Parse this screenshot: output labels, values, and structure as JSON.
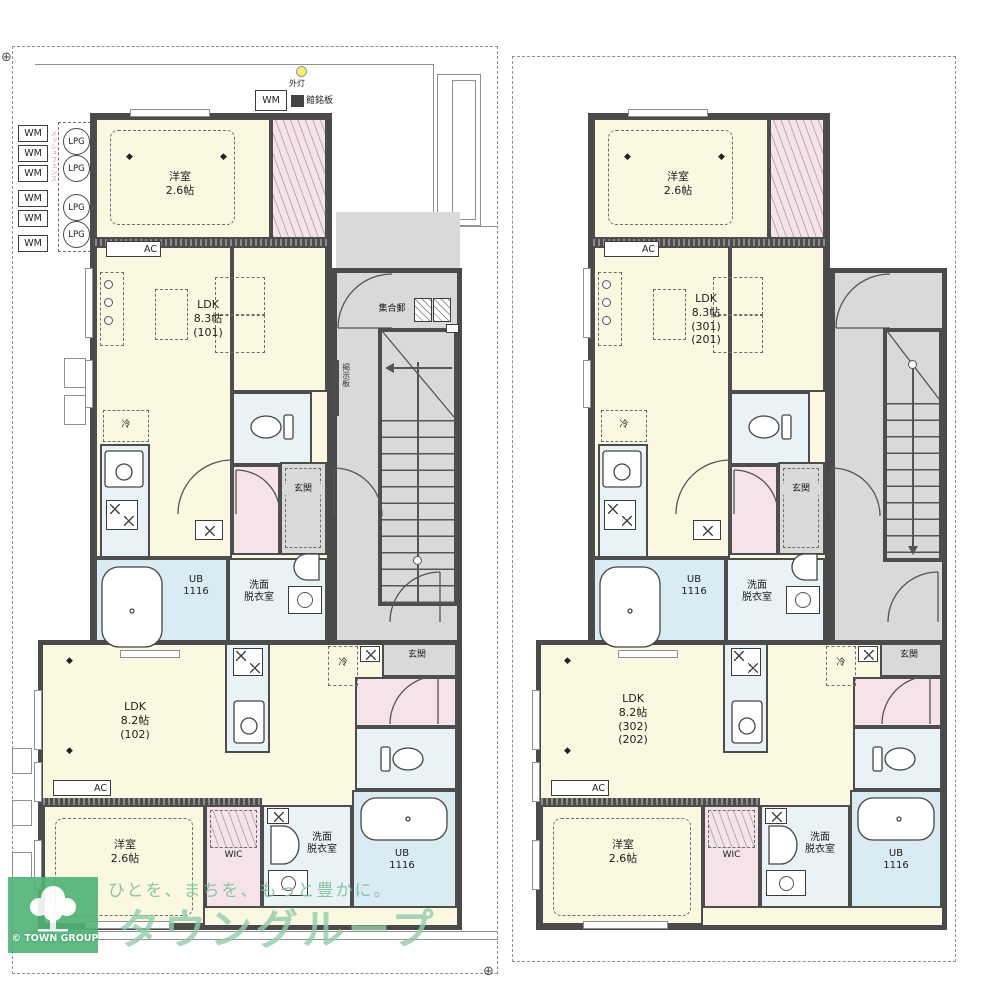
{
  "branding": {
    "tagline": "ひとを、まちを、もっと豊かに。",
    "company": "タウングループ",
    "logo_caption": "TOWN GROUP",
    "copyright": "©",
    "green_box": "#4eb377",
    "green_text": "#92ccac"
  },
  "site": {
    "wm": "WM",
    "lpg": "LPG",
    "outdoor_light": "外灯",
    "nameplate": "館銘板",
    "mailbox": "集合郵",
    "bulletin": "掲示板",
    "fence_note": "メッシュフェンス"
  },
  "common": {
    "ac": "AC",
    "fridge": "冷",
    "entrance": "玄関",
    "wic": "WIC",
    "washroom": "洗面\n脱衣室",
    "unit_bath": "UB\n1116",
    "bedroom": "洋室\n2.6帖"
  },
  "units": {
    "u101_ldk": "LDK\n8.3帖\n(101)",
    "u102_ldk": "LDK\n8.2帖\n(102)",
    "u301_ldk": "LDK\n8.3帖\n(301)\n(201)",
    "u302_ldk": "LDK\n8.2帖\n(302)\n(202)"
  }
}
